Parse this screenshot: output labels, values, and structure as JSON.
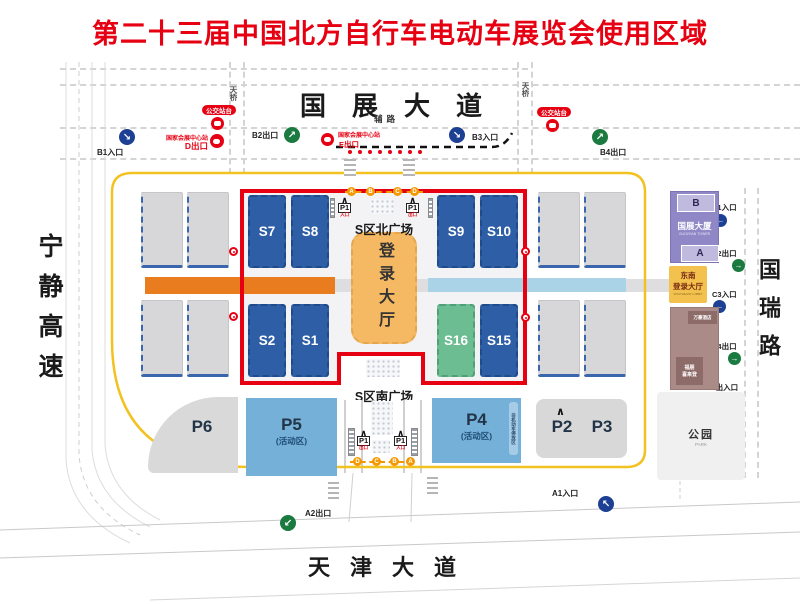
{
  "title": "第二十三届中国北方自行车电动车展览会使用区域",
  "roads": {
    "top": "国展大道",
    "bottom": "天津大道",
    "left": "宁静高速",
    "right": "国瑞路",
    "aux": "辅路",
    "bridge": "天桥"
  },
  "plazas": {
    "north": "S区北广场",
    "south": "S区南广场"
  },
  "login_hall": "登录大厅",
  "halls": {
    "s7": "S7",
    "s8": "S8",
    "s9": "S9",
    "s10": "S10",
    "s2": "S2",
    "s1": "S1",
    "s16": "S16",
    "s15": "S15"
  },
  "parking": {
    "p6": "P6",
    "p5": "P5",
    "p5_sub": "(活动区)",
    "p4": "P4",
    "p4_sub": "(活动区)",
    "p4_note": "非机动车停放区",
    "p2": "P2",
    "p3": "P3"
  },
  "park": {
    "name": "公园",
    "name_en": "PARK"
  },
  "gates": {
    "b1": "B1入口",
    "b2": "B2出口",
    "b3": "B3入口",
    "b4": "B4出口",
    "c1": "C1入口",
    "c2": "C2出口",
    "c3": "C3入口",
    "c4": "C4出口",
    "c5": "C5出入口",
    "a1": "A1入口",
    "a2": "A2出口"
  },
  "transit": {
    "bus_stop": "公交站台",
    "station": "国家会展中心站",
    "exit_d": "D出口",
    "exit_e": "E出口"
  },
  "p1": {
    "label": "P1",
    "in": "入口",
    "out": "出口"
  },
  "symbols": {
    "caret": "∧"
  },
  "arrows": {
    "in_dr": "↘",
    "out_ur": "↗",
    "in_l": "←",
    "out_r": "→",
    "in_ul": "↖",
    "out_dl": "↙"
  },
  "route_letters": {
    "north": [
      "A",
      "B",
      "C",
      "D"
    ],
    "south": [
      "D",
      "C",
      "B",
      "A"
    ]
  },
  "right_buildings": {
    "tower_b": "B",
    "tower_name": "国展大厦",
    "tower_en": "GUOZHAN TOWER",
    "tower_a": "A",
    "lobby_l1": "东南",
    "lobby_l2": "登录大厅",
    "lobby_en": "SOUTHEAST LOBBY",
    "hotel_top": "万豪酒店",
    "hotel_bot_l1": "福朋",
    "hotel_bot_l2": "喜来登"
  },
  "colors": {
    "accent_red": "#e60012",
    "ring_yellow": "#f2c220",
    "hall_blue": "#2d5ea6",
    "hall_green": "#6cbd92",
    "login_orange": "#f4b962",
    "band_orange": "#e87c1e",
    "band_blue": "#abd3e8",
    "parking_blue": "#74b0d8",
    "tower_purple": "#8f87c6",
    "lobby_yellow": "#f2c14e",
    "hotel_brown": "#ab8b88",
    "gate_in_blue": "#1d3f94",
    "gate_out_green": "#1b7a3f",
    "letter_orange": "#f39800"
  }
}
